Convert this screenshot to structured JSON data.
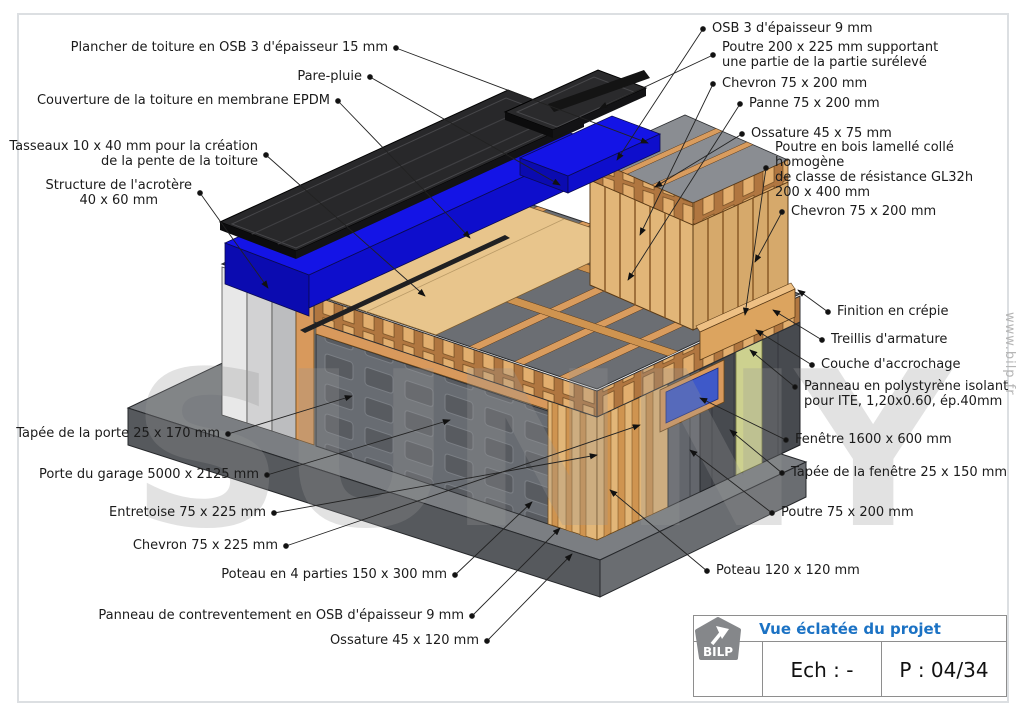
{
  "callouts": {
    "left": [
      {
        "text": "Plancher de toiture en OSB 3 d'épaisseur 15 mm"
      },
      {
        "text": "Pare-pluie"
      },
      {
        "text": "Couverture de la toiture en membrane EPDM"
      },
      {
        "text": "Tasseaux 10 x 40 mm pour la création\nde la pente de la toiture"
      },
      {
        "text": "Structure de l'acrotère\n40 x 60 mm"
      },
      {
        "text": "Tapée de la porte 25 x 170 mm"
      },
      {
        "text": "Porte du garage 5000 x 2125 mm"
      },
      {
        "text": "Entretoise 75 x 225 mm"
      },
      {
        "text": "Chevron 75 x 225 mm"
      },
      {
        "text": "Poteau en 4 parties 150 x 300 mm"
      },
      {
        "text": "Panneau de contreventement en OSB d'épaisseur 9 mm"
      },
      {
        "text": "Ossature 45 x 120 mm"
      }
    ],
    "right": [
      {
        "text": "OSB 3 d'épaisseur 9 mm"
      },
      {
        "text": "Poutre 200 x 225 mm supportant\nune partie de la partie surélevé"
      },
      {
        "text": "Chevron 75 x 200 mm"
      },
      {
        "text": "Panne 75 x 200 mm"
      },
      {
        "text": "Ossature 45 x 75 mm"
      },
      {
        "text": "Poutre en bois lamellé collé homogène\nde classe de résistance GL32h\n200 x 400 mm"
      },
      {
        "text": "Chevron 75 x 200 mm"
      },
      {
        "text": "Finition en crépie"
      },
      {
        "text": "Treillis d'armature"
      },
      {
        "text": "Couche d'accrochage"
      },
      {
        "text": "Panneau en polystyrène isolant\npour ITE, 1,20x0.60, ép.40mm"
      },
      {
        "text": "Fenêtre 1600 x 600 mm"
      },
      {
        "text": "Tapée de la fenêtre 25 x 150 mm"
      },
      {
        "text": "Poutre 75 x 200 mm"
      },
      {
        "text": "Poteau 120 x 120 mm"
      }
    ]
  },
  "title_block": {
    "title": "Vue éclatée du projet",
    "logo_text": "BILP",
    "scale_value": "Ech : -",
    "page_value": "P : 04/34"
  },
  "watermarks": {
    "diagonal": "SUNNY",
    "side": "www.bilp.fr"
  },
  "colors": {
    "title_blue": "#1B72C4",
    "membrane_black": "#28282A",
    "membrane_blue": "#1414E6",
    "wood": "#D99C5E",
    "osb": "#E8C58C",
    "wall_gray": "#63666C",
    "polystyrene_green": "#CDD18F",
    "slab_gray": "#6A6D71"
  }
}
